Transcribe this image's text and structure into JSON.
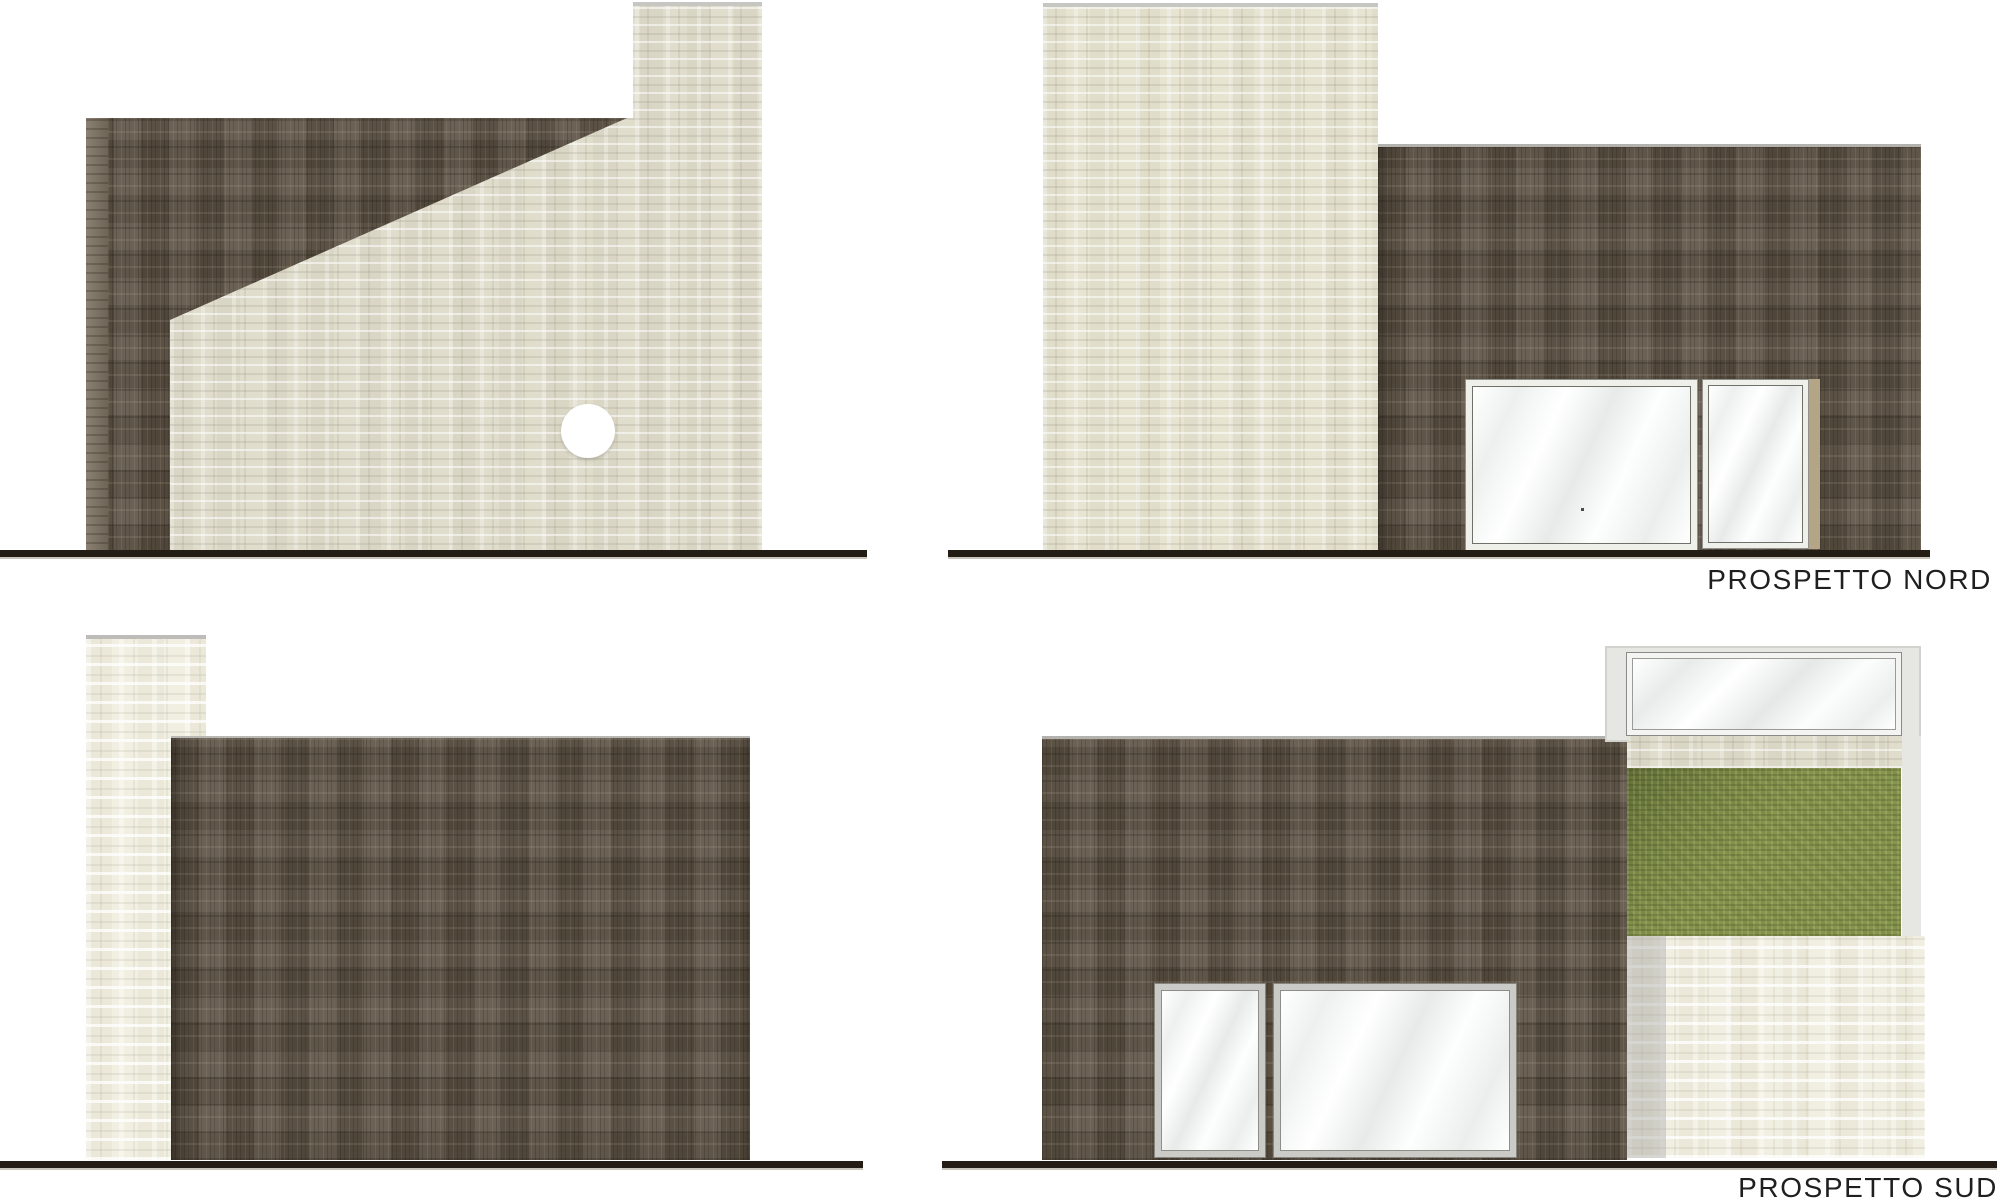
{
  "drawing": {
    "sheet_type": "architectural-elevations",
    "elevations": [
      {
        "id": "est",
        "label": "PROSPETTO EST"
      },
      {
        "id": "nord",
        "label": "PROSPETTO NORD"
      },
      {
        "id": "ovest",
        "label": "PROSPETTO OVEST"
      },
      {
        "id": "sud",
        "label": "PROSPETTO SUD"
      }
    ],
    "colors": {
      "wood_brown": "#5d5244",
      "cream": "#e0ddcd",
      "bright_cream": "#f1efe2",
      "grass_green": "#87964e",
      "frame_gray": "#e6e6e3",
      "glass_white": "#fbfcfc",
      "ground_dark": "#231d16",
      "label_text": "#1f1f1f",
      "background": "#ffffff"
    }
  }
}
